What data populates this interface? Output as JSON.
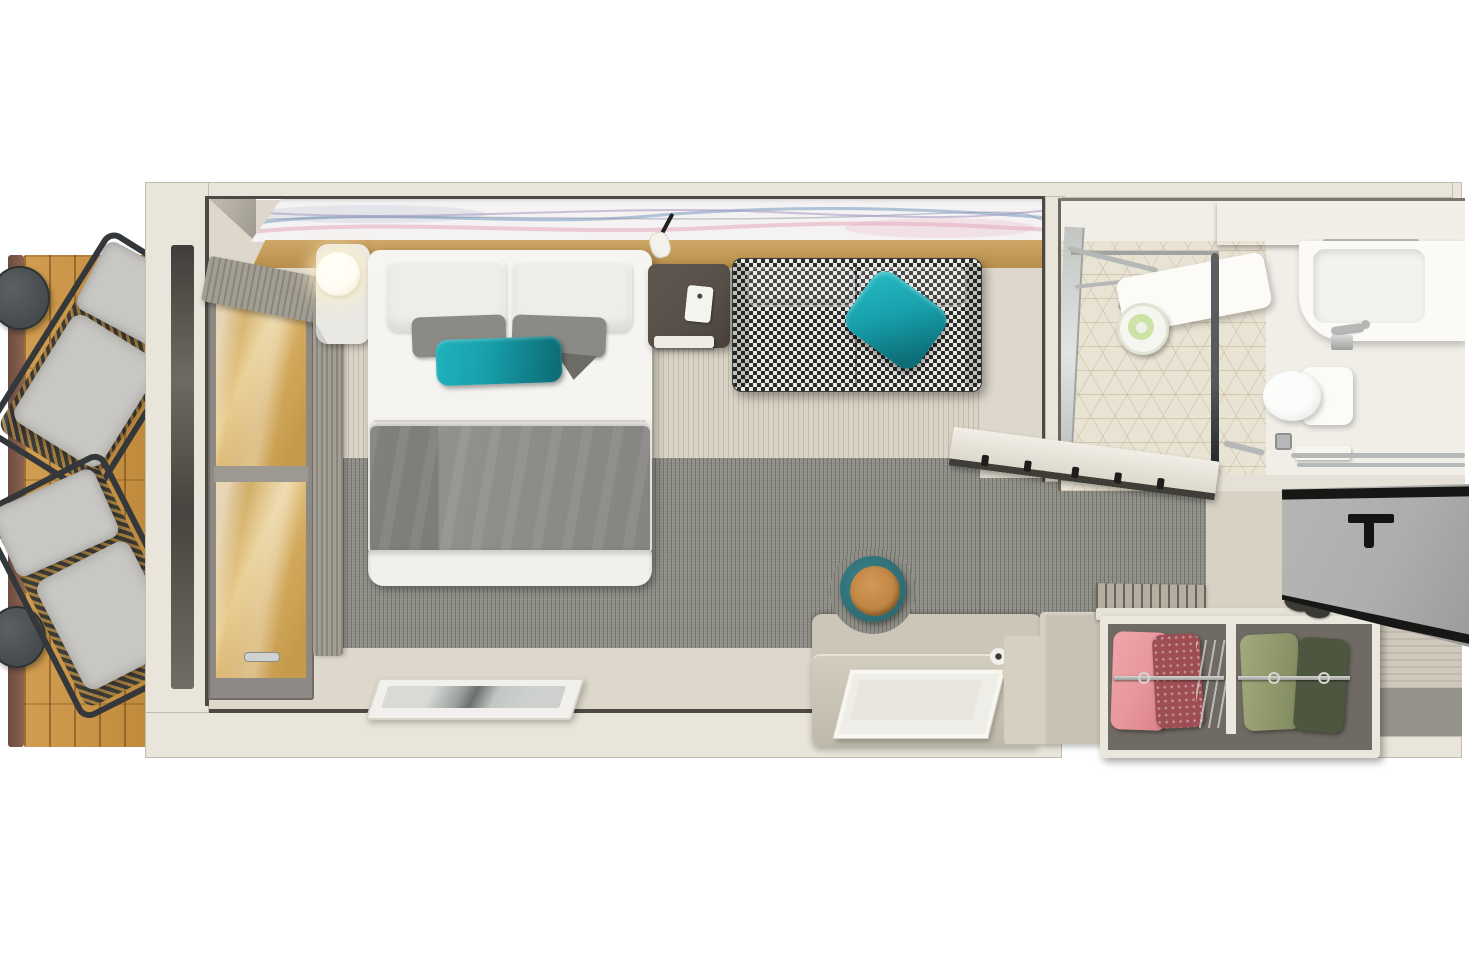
{
  "scene": {
    "stage": {
      "label": "cruise stateroom floor plan 3d render"
    },
    "balcony": {
      "label": "balcony",
      "items": [
        "side-table",
        "lounge-chair",
        "lounge-chair",
        "side-table",
        "wood-deck",
        "railing"
      ]
    },
    "bedroom": {
      "label": "bedroom",
      "items": [
        "artwork-strip",
        "headboard-ledge",
        "reading-light",
        "bedside-table",
        "lamp",
        "bed",
        "pillows",
        "teal-accent-pillow",
        "blanket",
        "nightstand",
        "phone",
        "sofa",
        "sofa-teal-pillow",
        "window",
        "curtain",
        "tv-panel",
        "desk",
        "tray",
        "stool",
        "steps"
      ]
    },
    "bed": {
      "label": "queen bed"
    },
    "sofa": {
      "label": "houndstooth sofa"
    },
    "desk": {
      "label": "vanity desk with stool"
    },
    "window": {
      "label": "balcony window"
    },
    "closet": {
      "label": "open wardrobe with hanging clothes",
      "items": [
        "pink-garment",
        "red-garment",
        "hangers",
        "green-garment",
        "dark-green-garment"
      ]
    },
    "bathroom": {
      "label": "bathroom",
      "items": [
        "shower",
        "shower-bench",
        "towel-roll",
        "glass-partition",
        "toilet",
        "vanity-sink",
        "faucet",
        "shelf",
        "towel-rails",
        "floor-drain"
      ]
    },
    "toilet": {
      "label": "toilet"
    },
    "vanity": {
      "label": "bathroom vanity sink"
    },
    "shower": {
      "label": "shower area"
    },
    "entry": {
      "label": "entryway",
      "items": [
        "entry-door",
        "shoes",
        "door-mat",
        "ribbed-wall"
      ]
    },
    "door": {
      "label": "entry door (open)"
    }
  },
  "palette": {
    "bg": "#ffffff",
    "wall": "#e9e5da",
    "trim": "#4d4a44",
    "trimSoft": "#c2bcae",
    "deckA": "#d19d50",
    "deckB": "#c08a3c",
    "rail": "#6d4b40",
    "chairFrame": "#34383a",
    "cushion": "#c8c7c3",
    "weaveTan": "#a07c43",
    "tableDark": "#464b4e",
    "vinyl": "#ddd8cb",
    "carpetLight": "#dad4c6",
    "carpetGray": "#8f8e87",
    "artBase": "#f4f2f2",
    "artBlue": "#93aecb",
    "artPink": "#e7aec2",
    "artPurple": "#a89bc4",
    "artGray": "#8d96aa",
    "ledgeA": "#cfa766",
    "ledgeB": "#b88e4b",
    "marble": "#eae8e3",
    "lamp": "#fffdf2",
    "bedWhite": "#f4f3f0",
    "pillowWhite": "#efedea",
    "pillowGray": "#8b8a85",
    "pillowGrayDark": "#6d6c67",
    "teal": "#17a0ab",
    "tealDark": "#0c6d76",
    "blanket": "#8e8c87",
    "foot": "#f2f0ec",
    "stand": "#564f48",
    "phone": "#f5f3ee",
    "sofaBase": "#e9e9e6",
    "sofaInk": "#2c2c2a",
    "windowFrame": "#8d8984",
    "glassWoodA": "#caa258",
    "glassWoodB": "#e8cc8e",
    "curtain": "#a39e94",
    "curtainLine": "#8a857b",
    "tvFrame": "#f1f0ec",
    "tvScreen": "#cdd0cc",
    "deskA": "#d3cdbf",
    "deskB": "#bfb9ab",
    "deskBack": "#ccc6b8",
    "tray": "#efede7",
    "stoolSeatA": "#d29a56",
    "stoolSeatB": "#b97f3d",
    "stoolRing": "#2e6c73",
    "step": "#c8c2b4",
    "stepLight": "#d6d0c2",
    "slat": "#b5afa1",
    "closetFrame": "#ebe7dc",
    "closetIn": "#6f6b64",
    "chromeA": "#d6d6d3",
    "chromeB": "#9d9d9a",
    "pink": "#e8989d",
    "red": "#9e4e53",
    "green": "#8f976c",
    "greenDark": "#4d563f",
    "shoe": "#3b3934",
    "doorGray": "#adadab",
    "doorInk": "#171715",
    "entryFloor": "#d6d1c3",
    "ribbed": "#cfc9bb",
    "mat": "#95928b",
    "bathFloor": "#f1eee8",
    "tile": "#e9e3d4",
    "shelf": "#a49e94",
    "white": "#fbfaf7",
    "sinkIn": "#f3f2ee",
    "chrome": "#b5b8b6",
    "steel": "#55595a",
    "glassEdge": "#9fa3a1",
    "towelGreen": "#cde2a6",
    "benchWhite": "#fcfbf8"
  }
}
